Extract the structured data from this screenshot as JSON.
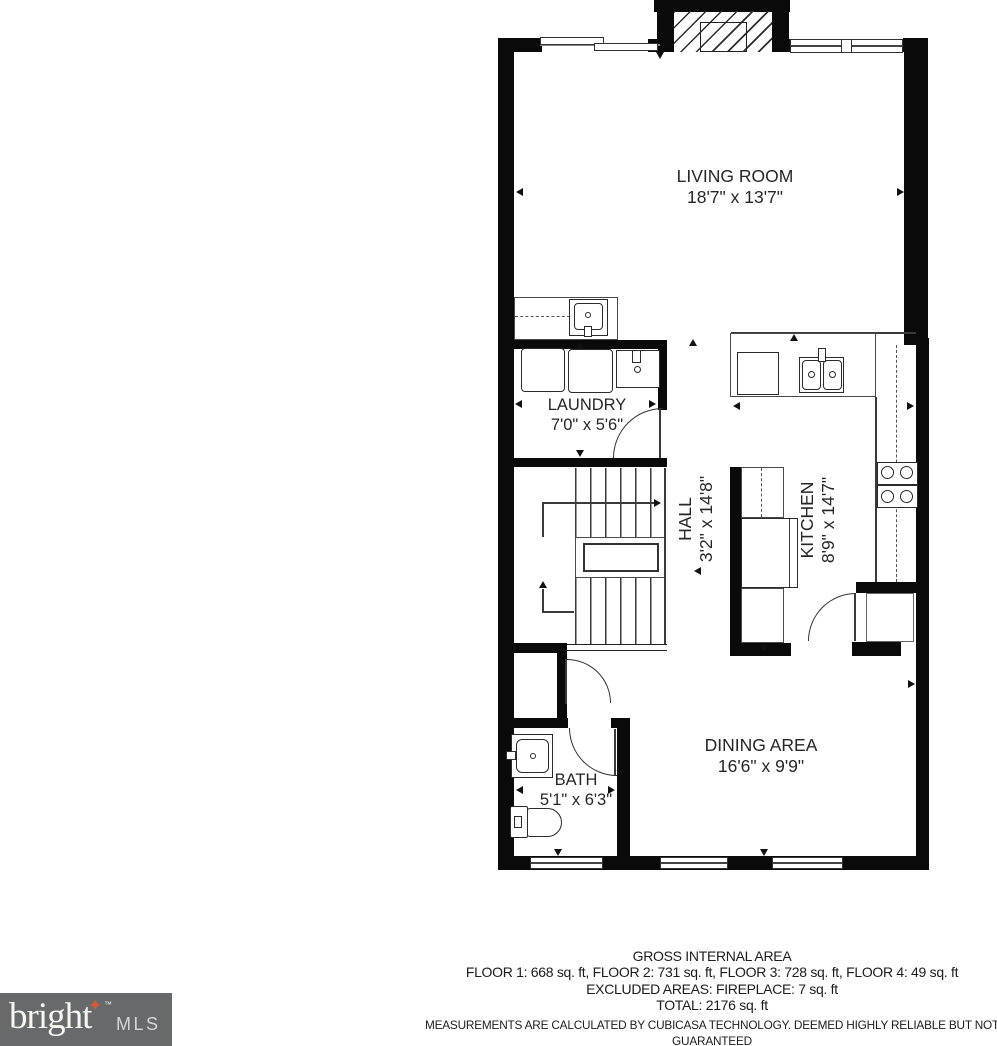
{
  "rooms": {
    "living": {
      "name": "LIVING ROOM",
      "dims": "18'7\" x 13'7\""
    },
    "laundry": {
      "name": "LAUNDRY",
      "dims": "7'0\" x 5'6\""
    },
    "hall": {
      "name": "HALL",
      "dims": "3'2\" x 14'8\""
    },
    "kitchen": {
      "name": "KITCHEN",
      "dims": "8'9\" x 14'7\""
    },
    "bath": {
      "name": "BATH",
      "dims": "5'1\" x 6'3\""
    },
    "dining": {
      "name": "DINING AREA",
      "dims": "16'6\" x 9'9\""
    }
  },
  "footer": {
    "title": "GROSS INTERNAL AREA",
    "floors": "FLOOR 1: 668 sq. ft, FLOOR 2: 731 sq. ft, FLOOR 3: 728 sq. ft, FLOOR 4: 49 sq. ft",
    "excluded": "EXCLUDED AREAS: FIREPLACE: 7 sq. ft",
    "total": "TOTAL: 2176 sq. ft",
    "disclaimer": "MEASUREMENTS ARE CALCULATED BY CUBICASA TECHNOLOGY. DEEMED HIGHLY RELIABLE BUT NOT GUARANTEED"
  },
  "logo": {
    "brand": "bright",
    "suffix": "MLS",
    "tm": "™",
    "star": "✦",
    "bg_color": "#68696b",
    "star_color": "#d75a33"
  }
}
